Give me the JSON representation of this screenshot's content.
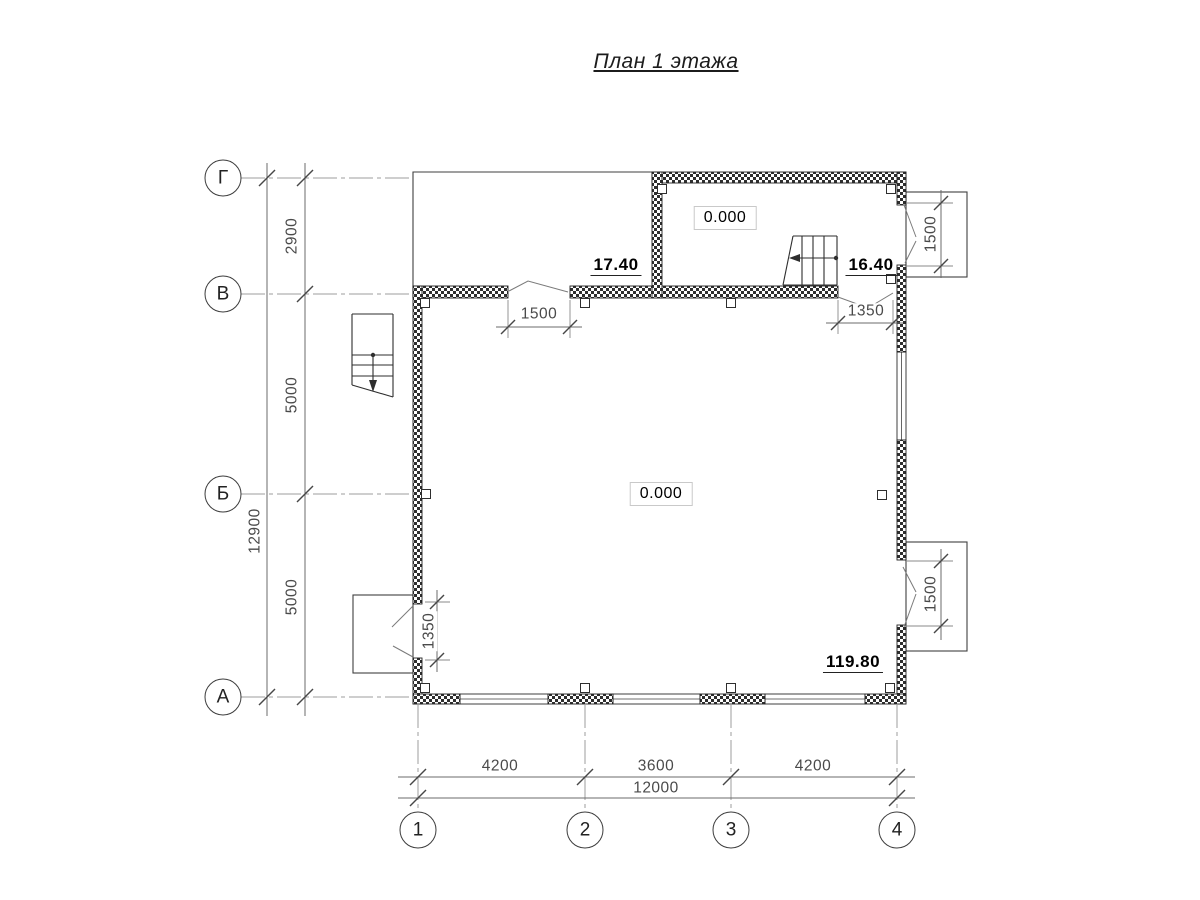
{
  "title": "План 1 этажа",
  "axes": {
    "rows": [
      "Г",
      "В",
      "Б",
      "А"
    ],
    "cols": [
      "1",
      "2",
      "3",
      "4"
    ]
  },
  "dimensions": {
    "left_segments": [
      "2900",
      "5000",
      "5000"
    ],
    "left_total": "12900",
    "bottom_segments": [
      "4200",
      "3600",
      "4200"
    ],
    "bottom_total": "12000",
    "openings": {
      "top_wall_door": "1500",
      "top_right_door": "1350",
      "left_wall_door": "1350",
      "right_bay_top": "1500",
      "right_bay_bottom": "1500"
    }
  },
  "levels": {
    "terrace": "17.40",
    "upper_room": "16.40",
    "zero_upper_room": "0.000",
    "zero_main_room": "0.000",
    "bottom_right": "119.80"
  },
  "colors": {
    "wall_hatch": "#2e2e2e",
    "axis_line": "#9c9c9c",
    "dim_line": "#6b6b6b",
    "dim_text": "#4a4a4a",
    "level_text": "#000000",
    "background": "#ffffff"
  }
}
